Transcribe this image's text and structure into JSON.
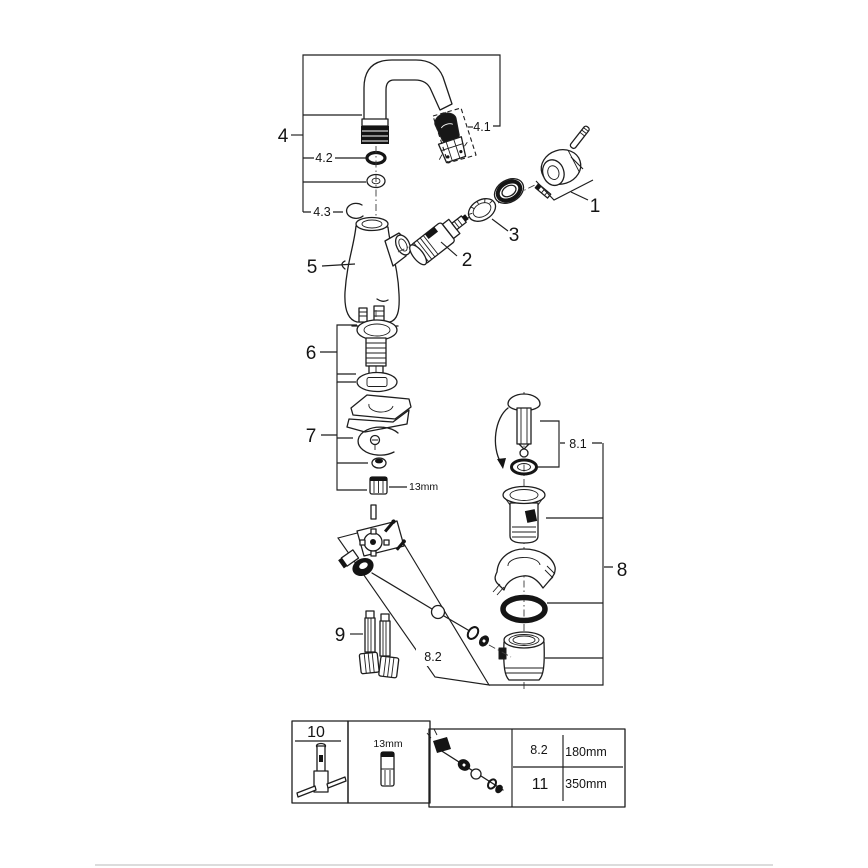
{
  "diagram_title": "Faucet exploded parts diagram",
  "colors": {
    "line": "#1e1e1e",
    "background": "#ffffff",
    "footer_rule": "#dcdcdc"
  },
  "callouts": {
    "c1": "1",
    "c2": "2",
    "c3": "3",
    "c4": "4",
    "c4_1": "4.1",
    "c4_2": "4.2",
    "c4_3": "4.3",
    "c5": "5",
    "c6": "6",
    "c7": "7",
    "c8": "8",
    "c8_1": "8.1",
    "c8_2": "8.2",
    "c9": "9",
    "nut_size": "13mm"
  },
  "legend": {
    "tool_ref": "10",
    "socket_size": "13mm",
    "rows": [
      {
        "ref": "8.2",
        "length": "180mm"
      },
      {
        "ref": "11",
        "length": "350mm"
      }
    ]
  }
}
